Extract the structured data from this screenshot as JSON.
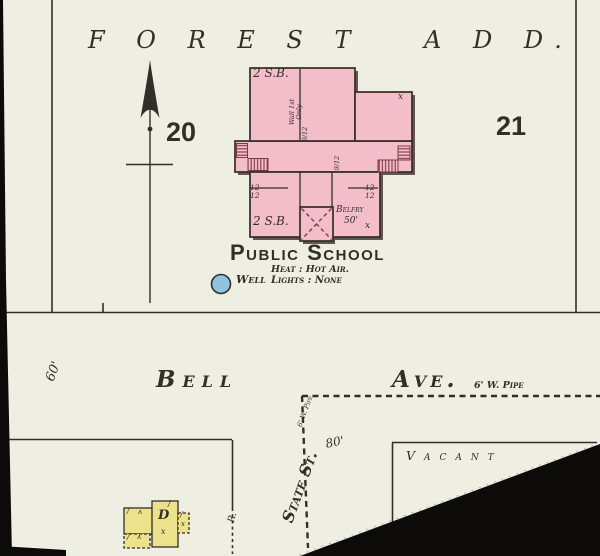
{
  "colors": {
    "paper": "#efeee3",
    "ink": "#332e27",
    "pink": "#f3bdc9",
    "pink_dark": "#7e3b44",
    "yellow": "#ece28c",
    "blue": "#8ec4e0",
    "black": "#0c0b09",
    "shadow": "#463c33"
  },
  "addition": {
    "name_part1": "F O R E S T",
    "name_part2": "A D D."
  },
  "blocks": {
    "left_number": "20",
    "right_number": "21"
  },
  "school": {
    "name": "Public School",
    "heat_note": "Heat : Hot Air.",
    "well_label": "Well",
    "lights_note": "Lights : None",
    "construction_top": "2 S.B.",
    "construction_bottom": "2 S.B.",
    "wall_note": "Wall 1st\nOnly",
    "roof_fraction_1": "9/12",
    "roof_fraction_2": "9/12",
    "window_note_left": "12\n12",
    "window_note_right": "12\n12",
    "belfry_label": "Belfry",
    "belfry_height": "50'",
    "x_mark_top": "x",
    "x_mark_bottom": "x"
  },
  "streets": {
    "bell_name": "Bell",
    "ave_suffix": "Ave.",
    "bell_pipe": "6' W. Pipe",
    "bell_width": "60'",
    "state_name": "State St.",
    "state_pipe": "6' W. Pipe",
    "state_width": "80'"
  },
  "lots": {
    "vacant_label": "Vacant",
    "rear_label": "R.",
    "dwelling_letter": "D",
    "dwelling_x": "x",
    "mark_slash": "/",
    "mark_caret": "ʌ"
  }
}
